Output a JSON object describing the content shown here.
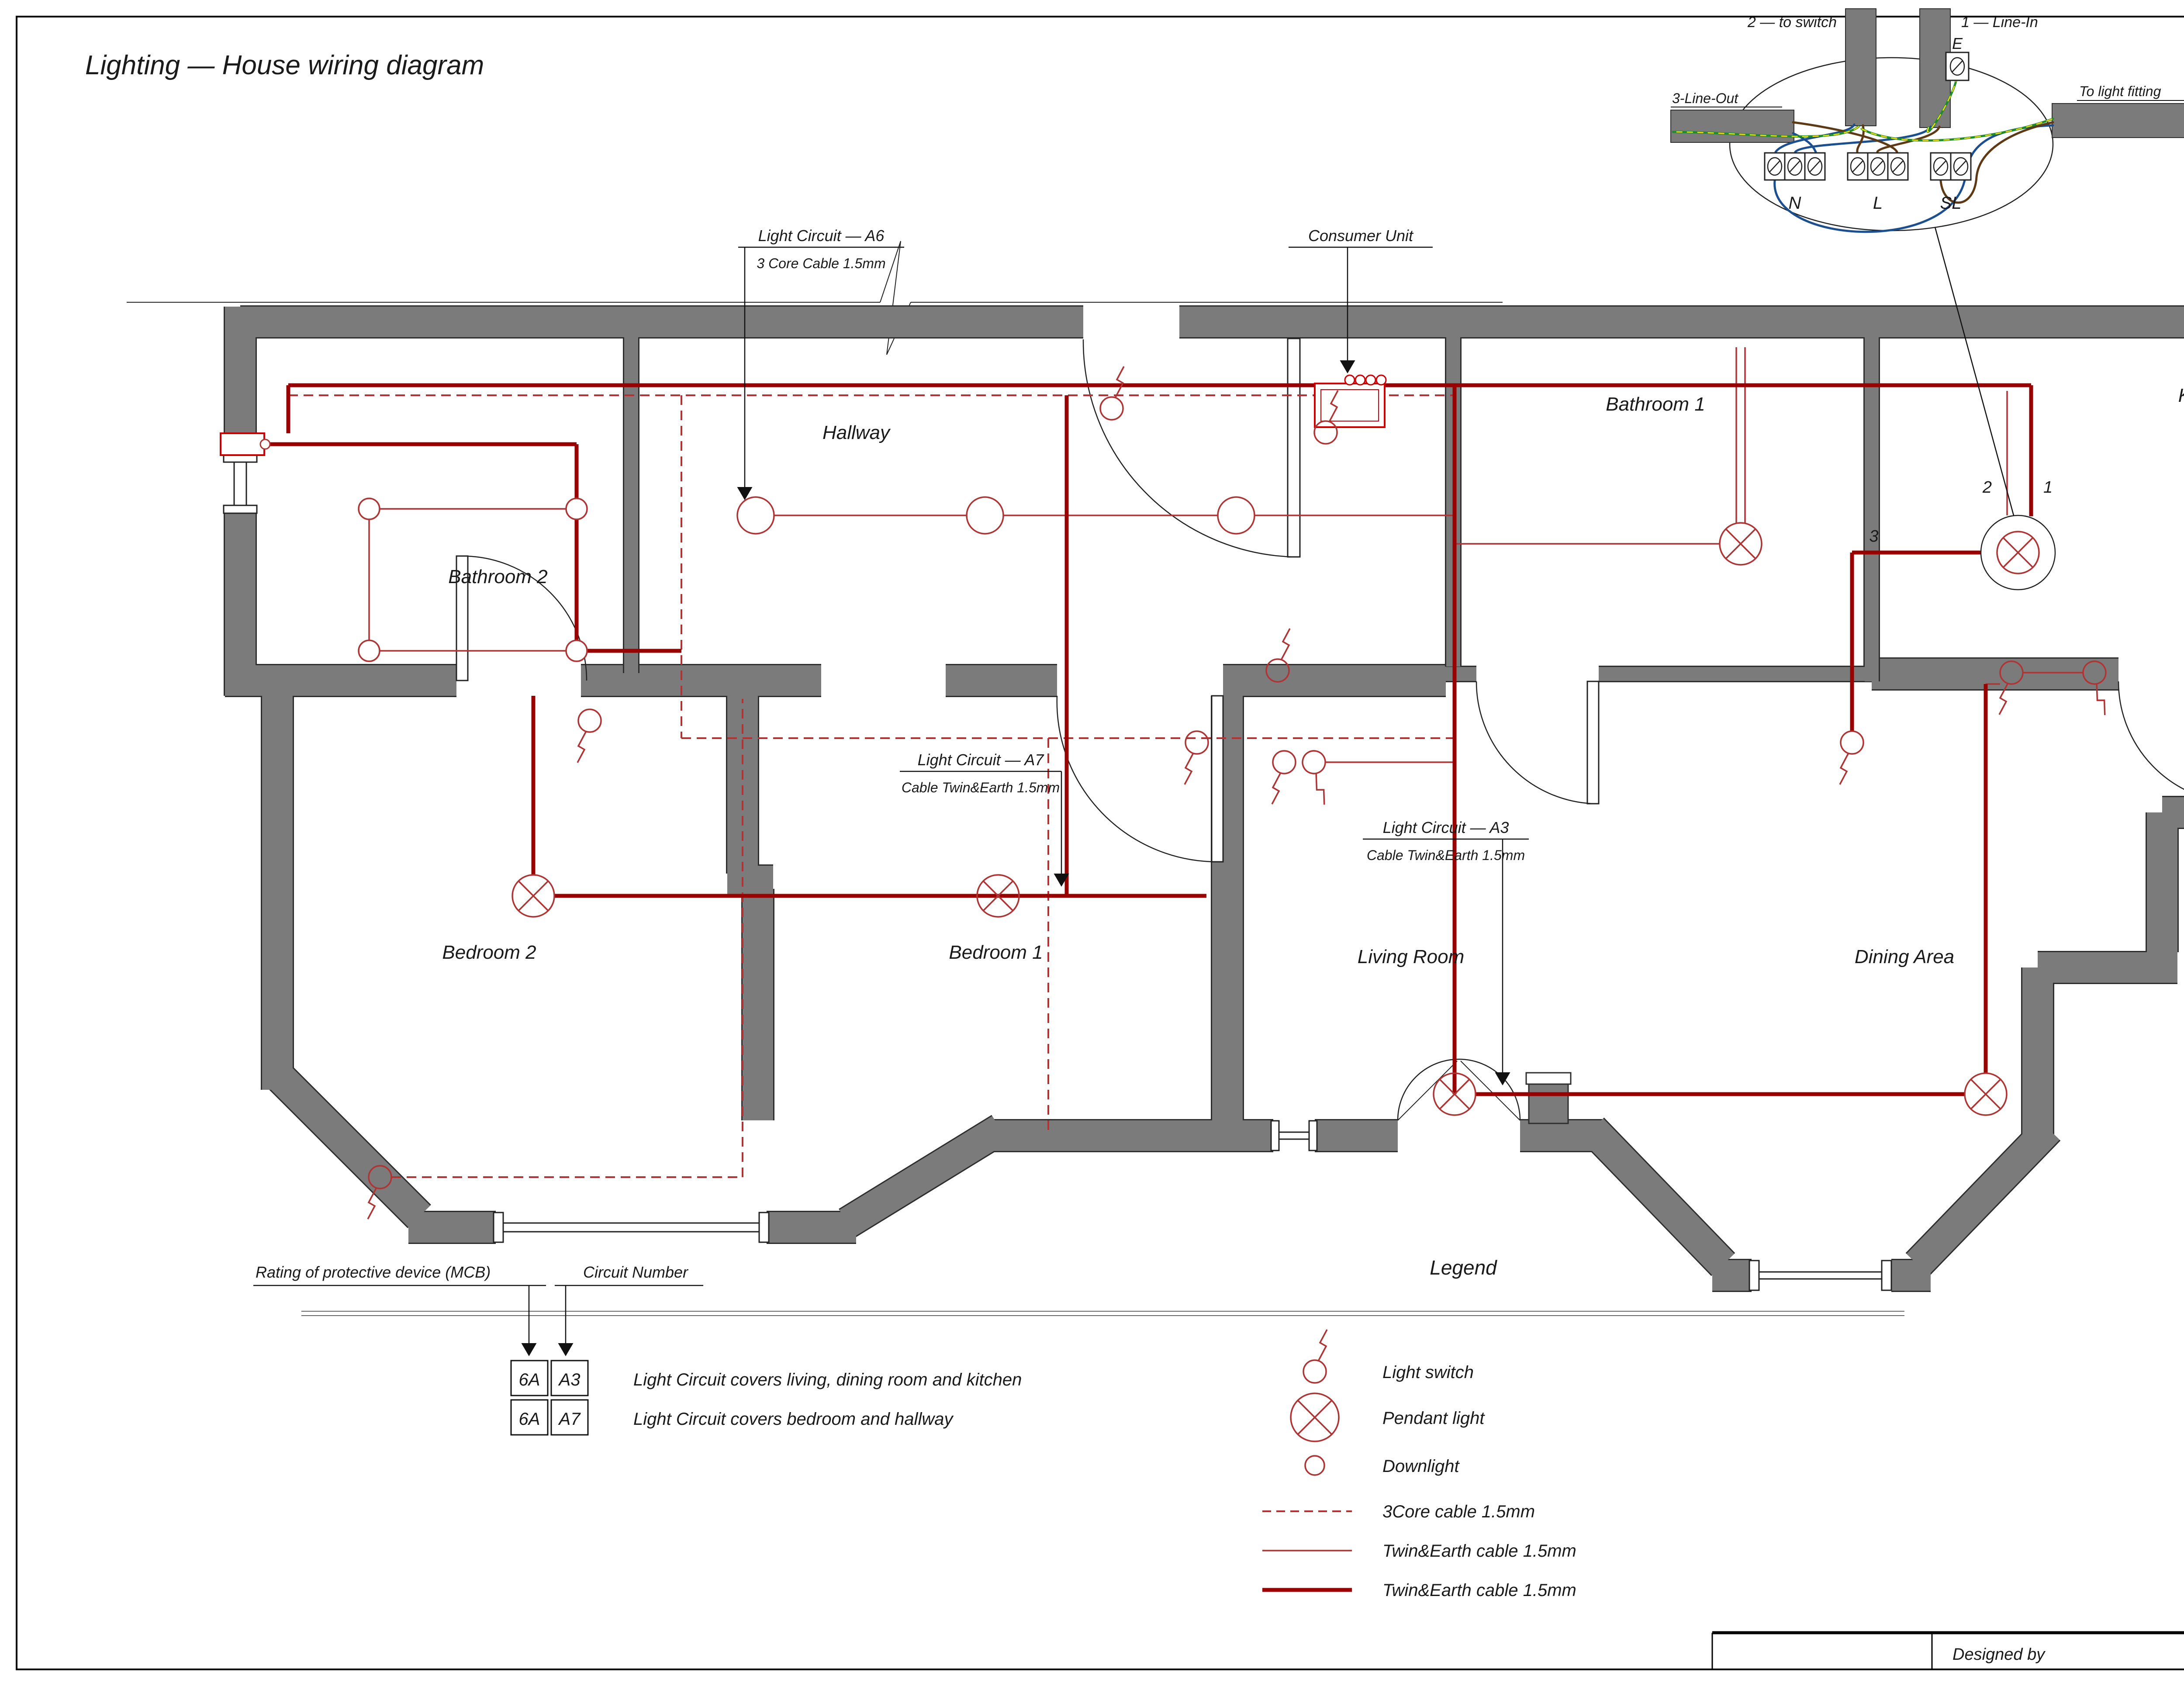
{
  "title": "Lighting — House wiring diagram",
  "rooms": {
    "bathroom2": "Bathroom 2",
    "hallway": "Hallway",
    "bathroom1": "Bathroom 1",
    "kitchen": "Kitchen",
    "bedroom2": "Bedroom 2",
    "bedroom1": "Bedroom 1",
    "living": "Living Room",
    "dining": "Dining Area"
  },
  "circuits": {
    "a6": {
      "name": "Light Circuit — A6",
      "cable": "3 Core Cable 1.5mm"
    },
    "a7": {
      "name": "Light Circuit — A7",
      "cable": "Cable Twin&Earth 1.5mm"
    },
    "a3": {
      "name": "Light Circuit — A3",
      "cable": "Cable Twin&Earth 1.5mm"
    }
  },
  "consumer_unit": "Consumer Unit",
  "junction_detail": {
    "to_switch": "2 — to switch",
    "line_in": "1 — Line-In",
    "line_out": "3-Line-Out",
    "to_light": "To light fitting",
    "earth": "E",
    "neutral": "N",
    "live": "L",
    "switched_live": "SL"
  },
  "kitchen_wire_numbers": {
    "n2": "2",
    "n1": "1",
    "n3": "3"
  },
  "mcb_table": {
    "rating_heading": "Rating of protective device (MCB)",
    "circuit_heading": "Circuit Number",
    "rows": [
      {
        "rating": "6A",
        "circuit": "A3",
        "description": "Light Circuit covers living, dining room and kitchen"
      },
      {
        "rating": "6A",
        "circuit": "A7",
        "description": "Light Circuit covers bedroom and hallway"
      }
    ]
  },
  "legend": {
    "title": "Legend",
    "items": [
      {
        "symbol": "light-switch",
        "label": "Light switch"
      },
      {
        "symbol": "pendant-light",
        "label": "Pendant light"
      },
      {
        "symbol": "downlight",
        "label": "Downlight"
      },
      {
        "symbol": "cable-3core-dashed",
        "label": "3Core cable 1.5mm"
      },
      {
        "symbol": "cable-twin-earth-thin",
        "label": "Twin&Earth cable 1.5mm"
      },
      {
        "symbol": "cable-twin-earth-thick",
        "label": "Twin&Earth cable 1.5mm"
      }
    ]
  },
  "title_block": {
    "designed_by": "Designed by"
  },
  "colors": {
    "wall": "#7b7b7b",
    "wall_edge": "#2e2e2e",
    "wire_thin": "#b03434",
    "wire_thick": "#990000",
    "wire_dashed": "#b03434",
    "consumer_unit": "#cc0000",
    "earth_green": "#1e8c28",
    "earth_yellow": "#ffe000",
    "neutral_blue": "#1c4f8f",
    "live_brown": "#5e3a14"
  }
}
